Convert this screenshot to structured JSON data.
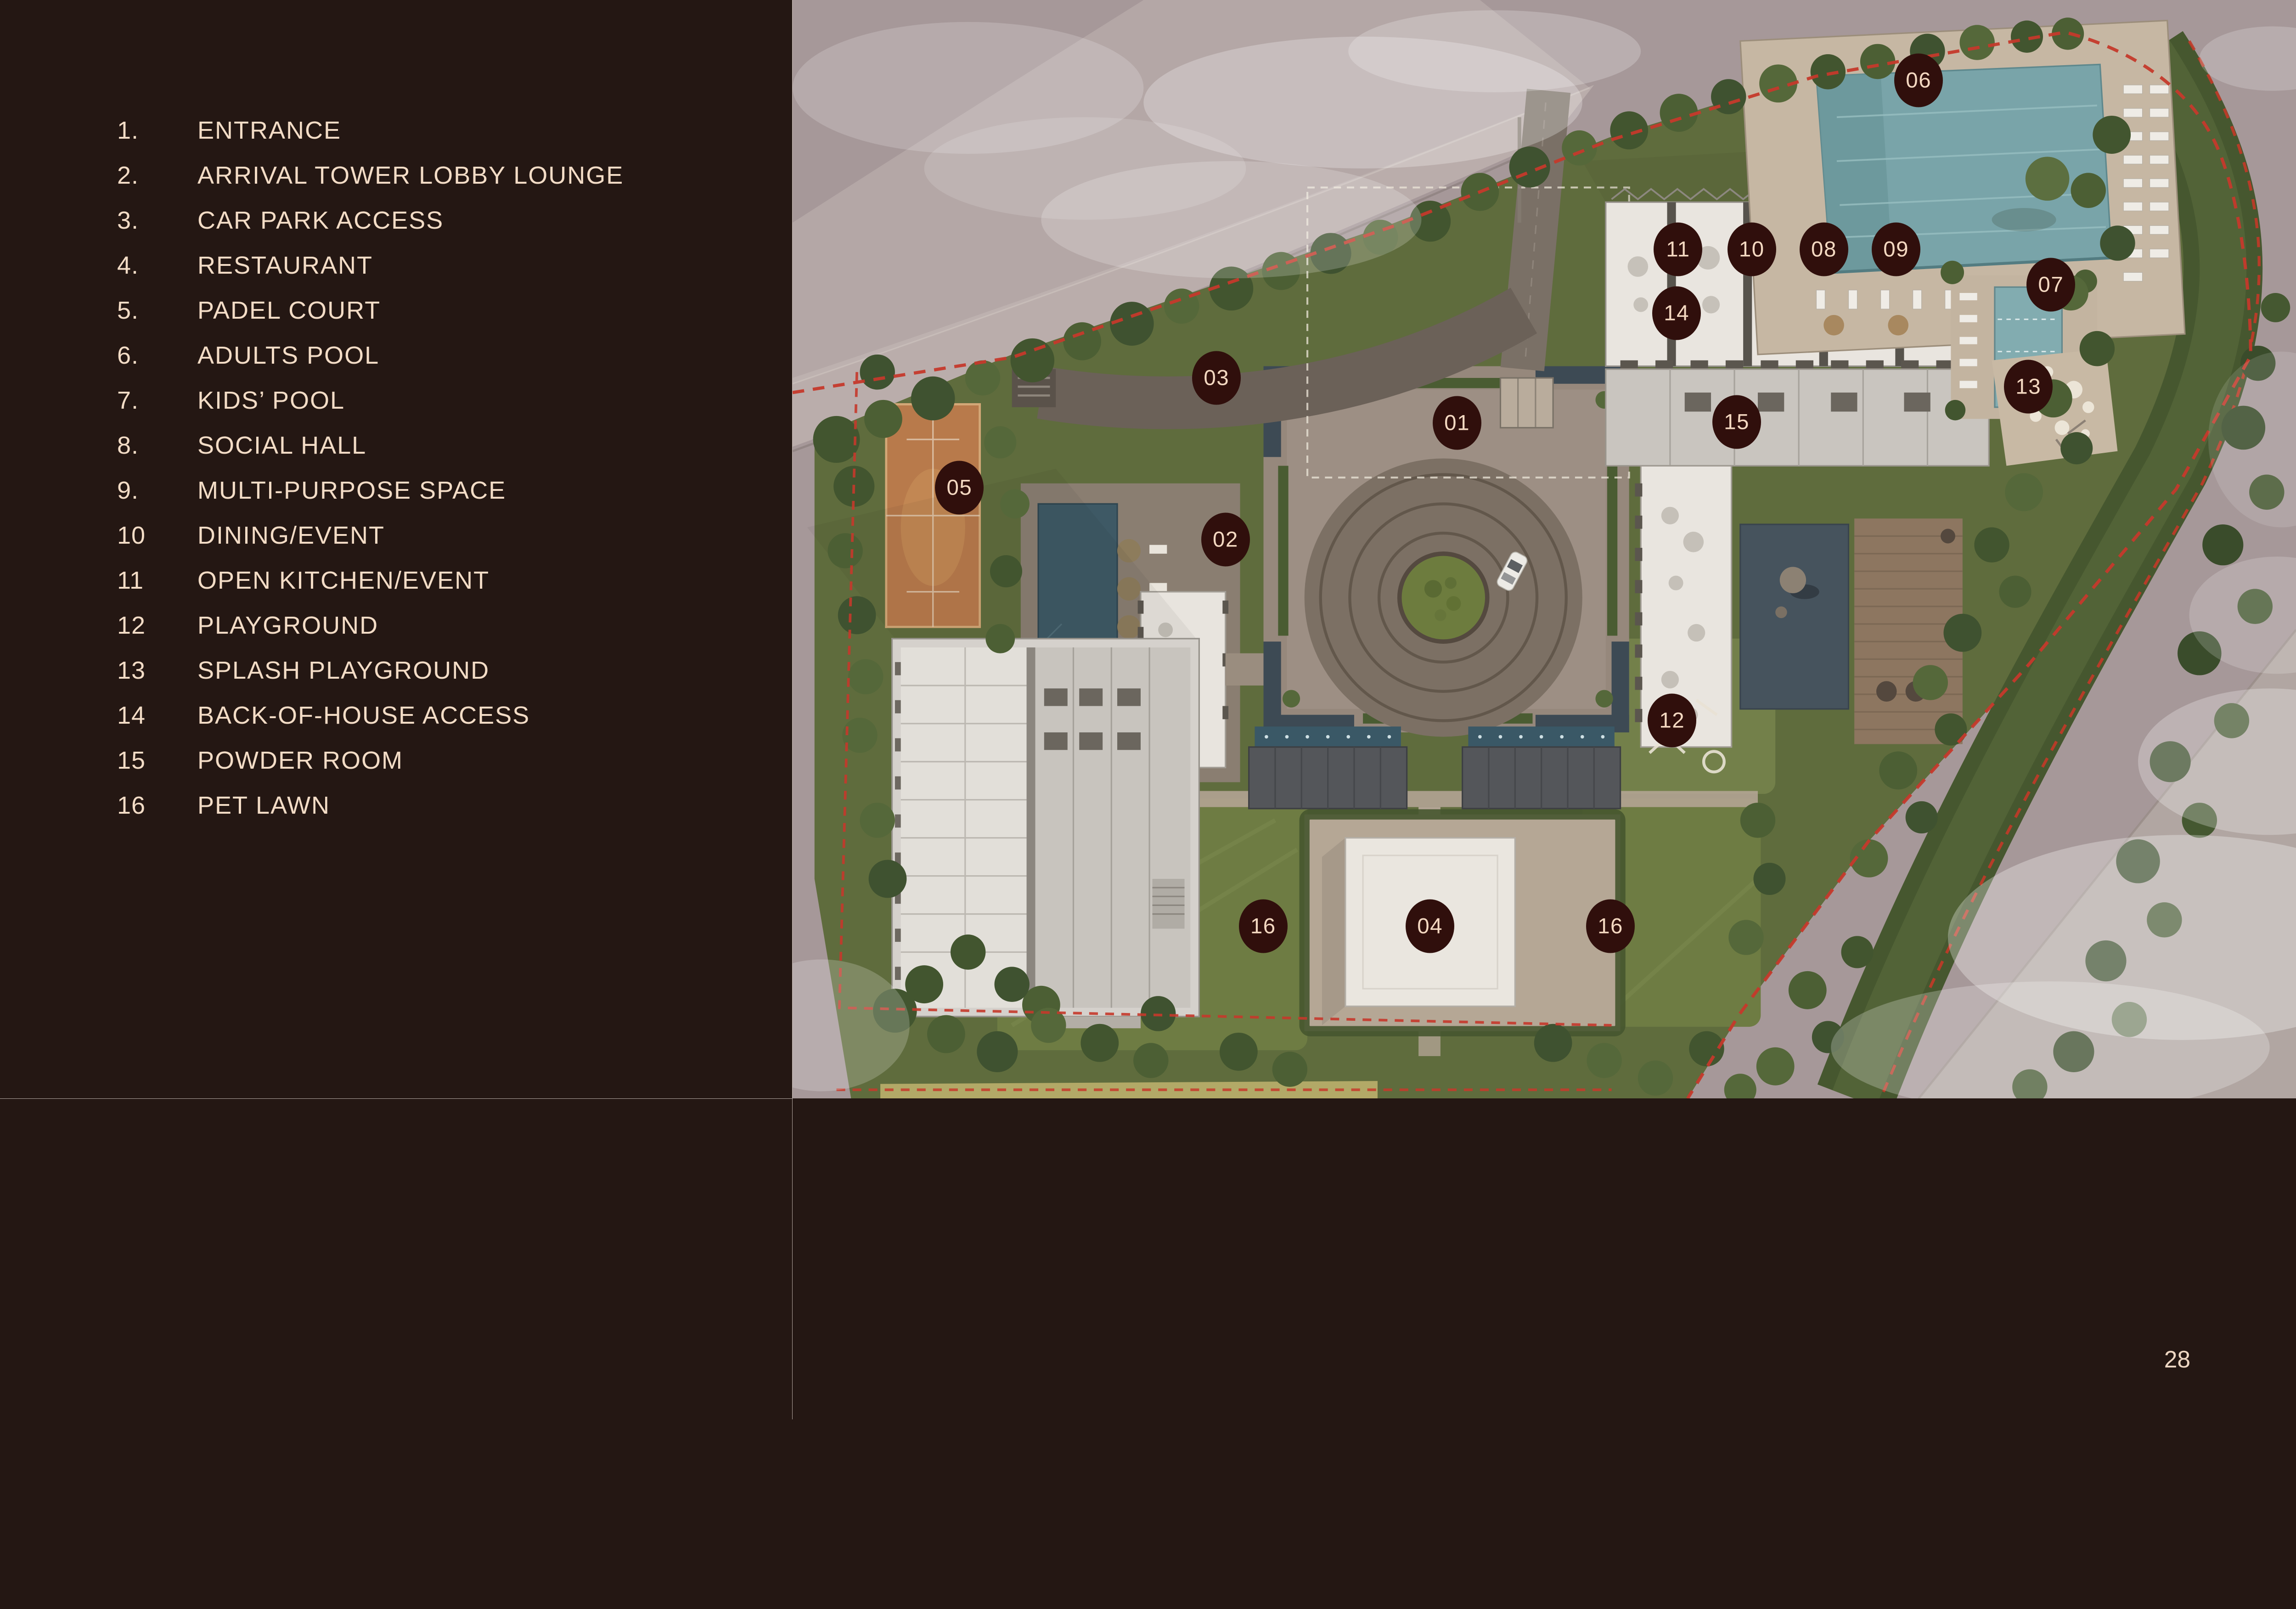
{
  "page": {
    "number": "28",
    "background": "#241713",
    "text_color": "#f3dcc6",
    "divider_color": "#b2a6a0"
  },
  "legend": {
    "items": [
      {
        "num": "1.",
        "label": "ENTRANCE"
      },
      {
        "num": "2.",
        "label": "ARRIVAL TOWER LOBBY LOUNGE"
      },
      {
        "num": "3.",
        "label": "CAR PARK ACCESS"
      },
      {
        "num": "4.",
        "label": "RESTAURANT"
      },
      {
        "num": "5.",
        "label": "PADEL COURT"
      },
      {
        "num": "6.",
        "label": "ADULTS POOL"
      },
      {
        "num": "7.",
        "label": "KIDS’ POOL"
      },
      {
        "num": "8.",
        "label": "SOCIAL HALL"
      },
      {
        "num": "9.",
        "label": "MULTI-PURPOSE SPACE"
      },
      {
        "num": "10",
        "label": "DINING/EVENT"
      },
      {
        "num": "11",
        "label": "OPEN KITCHEN/EVENT"
      },
      {
        "num": "12",
        "label": "PLAYGROUND"
      },
      {
        "num": "13",
        "label": "SPLASH PLAYGROUND"
      },
      {
        "num": "14",
        "label": "BACK-OF-HOUSE ACCESS"
      },
      {
        "num": "15",
        "label": "POWDER ROOM"
      },
      {
        "num": "16",
        "label": "PET LAWN"
      }
    ]
  },
  "map": {
    "markers": [
      {
        "id": "01",
        "x": 44.2,
        "y": 38.5
      },
      {
        "id": "02",
        "x": 28.8,
        "y": 49.1
      },
      {
        "id": "03",
        "x": 28.2,
        "y": 34.4
      },
      {
        "id": "04",
        "x": 42.4,
        "y": 84.3
      },
      {
        "id": "05",
        "x": 11.1,
        "y": 44.4
      },
      {
        "id": "06",
        "x": 74.9,
        "y": 7.3
      },
      {
        "id": "07",
        "x": 83.7,
        "y": 25.9
      },
      {
        "id": "08",
        "x": 68.6,
        "y": 22.7
      },
      {
        "id": "09",
        "x": 73.4,
        "y": 22.7
      },
      {
        "id": "10",
        "x": 63.8,
        "y": 22.7
      },
      {
        "id": "11",
        "x": 58.9,
        "y": 22.7
      },
      {
        "id": "12",
        "x": 58.5,
        "y": 65.6
      },
      {
        "id": "13",
        "x": 82.2,
        "y": 35.2
      },
      {
        "id": "14",
        "x": 58.8,
        "y": 28.5
      },
      {
        "id": "15",
        "x": 62.8,
        "y": 38.4
      },
      {
        "id": "16",
        "x": 31.3,
        "y": 84.3
      },
      {
        "id": "16",
        "x": 54.4,
        "y": 84.3
      }
    ],
    "colors": {
      "marker_bg": "#300f0c",
      "marker_text": "#f4d8c1",
      "boundary": "#c5392b"
    }
  }
}
